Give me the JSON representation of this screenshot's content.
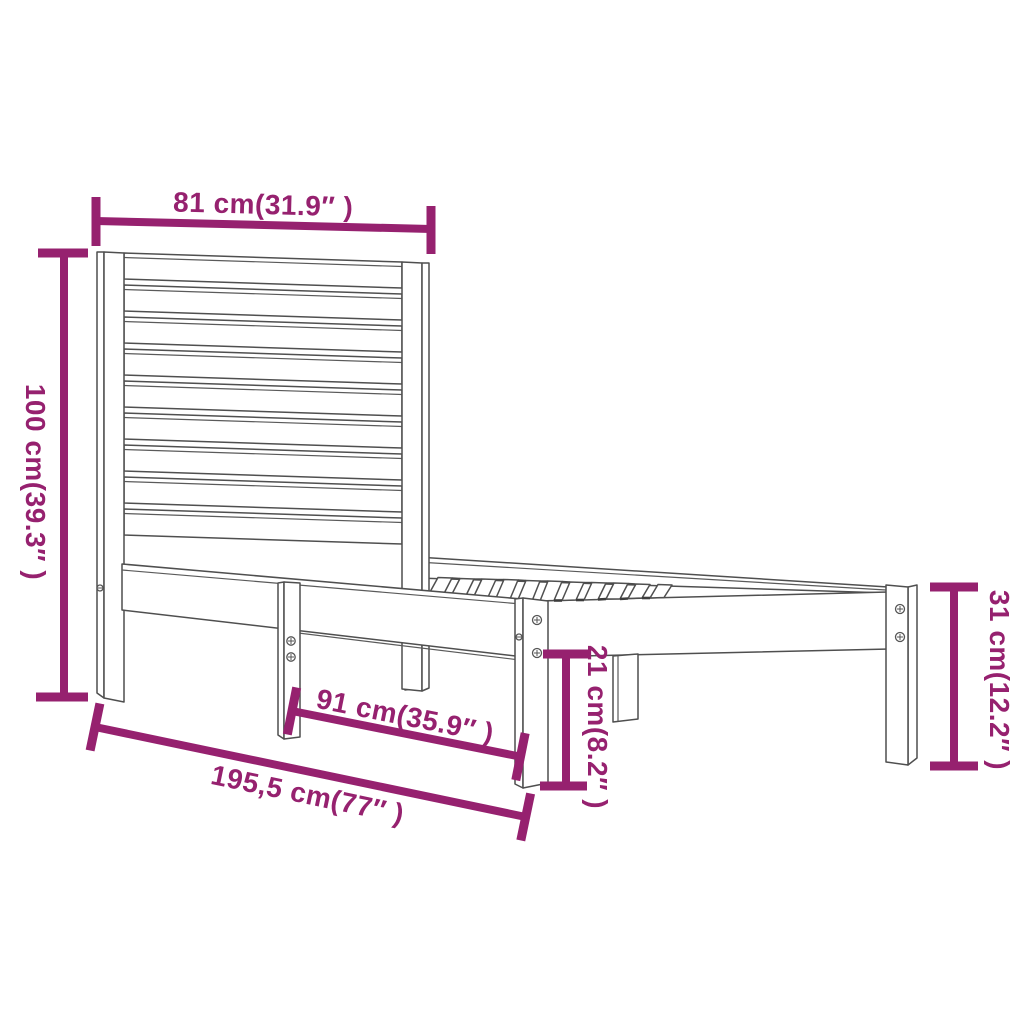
{
  "diagram": {
    "title": "bed-frame-dimension-diagram",
    "colors": {
      "background": "#ffffff",
      "line_art": "#4f4f4f",
      "dimension": "#96216F"
    },
    "labels": {
      "headboard_width": "81 cm(31.9″ )",
      "headboard_height": "100 cm(39.3″ )",
      "foot_end_height": "31 cm(12.2″ )",
      "under_rail_height": "21 cm(8.2″ )",
      "mid_leg_to_foot_length": "91 cm(35.9″ )",
      "total_length": "195,5 cm(77″ )"
    }
  }
}
